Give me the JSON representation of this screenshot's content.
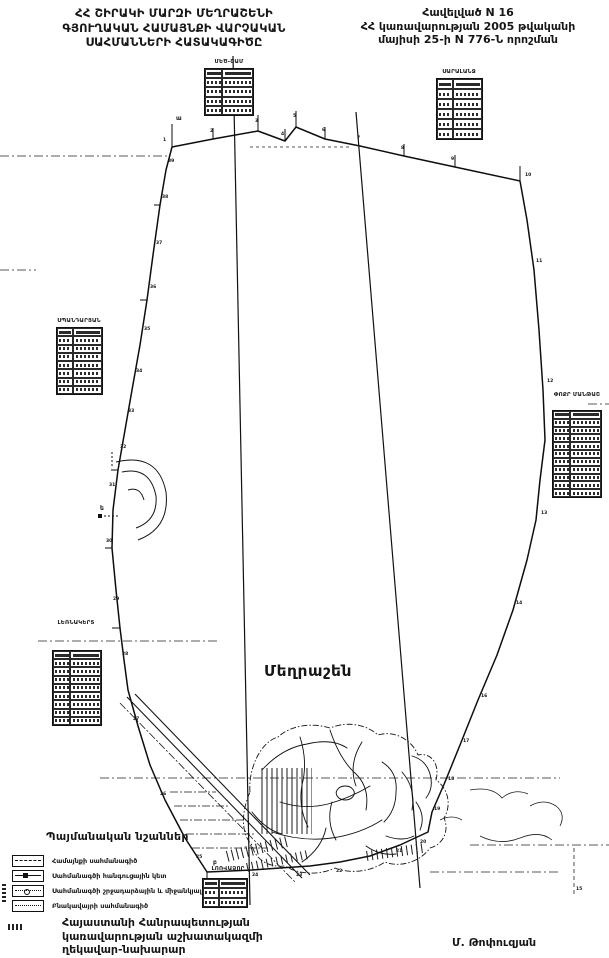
{
  "header": {
    "title_lines": [
      "ՀՀ ՇԻՐԱԿԻ ՄԱՐԶԻ ՄԵՂՐԱՇԵՆԻ",
      "ԳՅՈՒՂԱԿԱՆ ՀԱՄԱՅՆՔԻ ՎԱՐՉԱԿԱՆ",
      "ՍԱՀՄԱՆՆԵՐԻ ՀԱՏԱԿԱԳԻԾԸ"
    ],
    "appendix_lines": [
      "Հավելված N 16",
      "ՀՀ կառավարության 2005 թվականի",
      "մայիսի 25-ի N 776-Ն որոշման"
    ]
  },
  "map": {
    "settlement_label": "Մեղրաշեն",
    "neighbor_tables": [
      {
        "id": "t1",
        "label": "ՄԵԾ-ՇԱՄ",
        "rows": 5
      },
      {
        "id": "t2",
        "label": "ՍԱՐԱԼԱՆՋ",
        "rows": 6
      },
      {
        "id": "t3",
        "label": "ՍՊԱՆԴԱՐՅԱՆ",
        "rows": 8
      },
      {
        "id": "t4",
        "label": "ՓՈՔՐ ՄԱՆԹԱՇ",
        "rows": 11
      },
      {
        "id": "t5",
        "label": "ԼԵՌՆԱԿԵՐՏ",
        "rows": 9
      },
      {
        "id": "t6",
        "label": "ԼՈՌՎԱՁՈՐ",
        "rows": 3
      }
    ],
    "point_numbers": [
      {
        "n": "1",
        "x": 163,
        "y": 141
      },
      {
        "n": "2",
        "x": 210,
        "y": 132
      },
      {
        "n": "3",
        "x": 255,
        "y": 122
      },
      {
        "n": "4",
        "x": 281,
        "y": 135
      },
      {
        "n": "5",
        "x": 293,
        "y": 117
      },
      {
        "n": "6",
        "x": 322,
        "y": 131
      },
      {
        "n": "7",
        "x": 357,
        "y": 139
      },
      {
        "n": "8",
        "x": 401,
        "y": 149
      },
      {
        "n": "9",
        "x": 451,
        "y": 160
      },
      {
        "n": "10",
        "x": 525,
        "y": 176
      },
      {
        "n": "11",
        "x": 536,
        "y": 262
      },
      {
        "n": "12",
        "x": 547,
        "y": 382
      },
      {
        "n": "13",
        "x": 541,
        "y": 514
      },
      {
        "n": "14",
        "x": 516,
        "y": 604
      },
      {
        "n": "15",
        "x": 576,
        "y": 890
      },
      {
        "n": "16",
        "x": 481,
        "y": 697
      },
      {
        "n": "17",
        "x": 463,
        "y": 742
      },
      {
        "n": "18",
        "x": 448,
        "y": 780
      },
      {
        "n": "19",
        "x": 434,
        "y": 810
      },
      {
        "n": "20",
        "x": 420,
        "y": 843
      },
      {
        "n": "21",
        "x": 396,
        "y": 852
      },
      {
        "n": "22",
        "x": 336,
        "y": 872
      },
      {
        "n": "23",
        "x": 296,
        "y": 876
      },
      {
        "n": "24",
        "x": 252,
        "y": 876
      },
      {
        "n": "25",
        "x": 196,
        "y": 858
      },
      {
        "n": "26",
        "x": 160,
        "y": 795
      },
      {
        "n": "27",
        "x": 133,
        "y": 720
      },
      {
        "n": "28",
        "x": 122,
        "y": 655
      },
      {
        "n": "29",
        "x": 113,
        "y": 600
      },
      {
        "n": "30",
        "x": 106,
        "y": 542
      },
      {
        "n": "31",
        "x": 109,
        "y": 486
      },
      {
        "n": "32",
        "x": 120,
        "y": 448
      },
      {
        "n": "33",
        "x": 128,
        "y": 412
      },
      {
        "n": "34",
        "x": 136,
        "y": 372
      },
      {
        "n": "35",
        "x": 144,
        "y": 330
      },
      {
        "n": "36",
        "x": 150,
        "y": 288
      },
      {
        "n": "37",
        "x": 156,
        "y": 244
      },
      {
        "n": "38",
        "x": 162,
        "y": 198
      },
      {
        "n": "39",
        "x": 168,
        "y": 162
      }
    ],
    "junction_letters": [
      {
        "n": "ա",
        "x": 176,
        "y": 120
      },
      {
        "n": "ե",
        "x": 100,
        "y": 510
      },
      {
        "n": "բ",
        "x": 213,
        "y": 864
      }
    ]
  },
  "legend": {
    "title": "Պայմանական նշաններ",
    "items": [
      {
        "label": "Համայնքի սահմանագիծ",
        "symbol": "dashed-line"
      },
      {
        "label": "Սահմանագծի հանգուցային կետ",
        "symbol": "junction-point"
      },
      {
        "label": "Սահմանագծի շրջադարձային և միջանկյալ կետեր",
        "symbol": "turning-point"
      },
      {
        "label": "Բնակավայրի սահմանագիծ",
        "symbol": "dotted-line"
      }
    ]
  },
  "footer": {
    "official_lines": [
      "Հայաստանի Հանրապետության",
      "կառավարության աշխատակազմի",
      "ղեկավար-նախարար"
    ],
    "signature": "Մ. Թոփուզյան"
  },
  "colors": {
    "ink": "#161616",
    "paper": "#ffffff"
  }
}
